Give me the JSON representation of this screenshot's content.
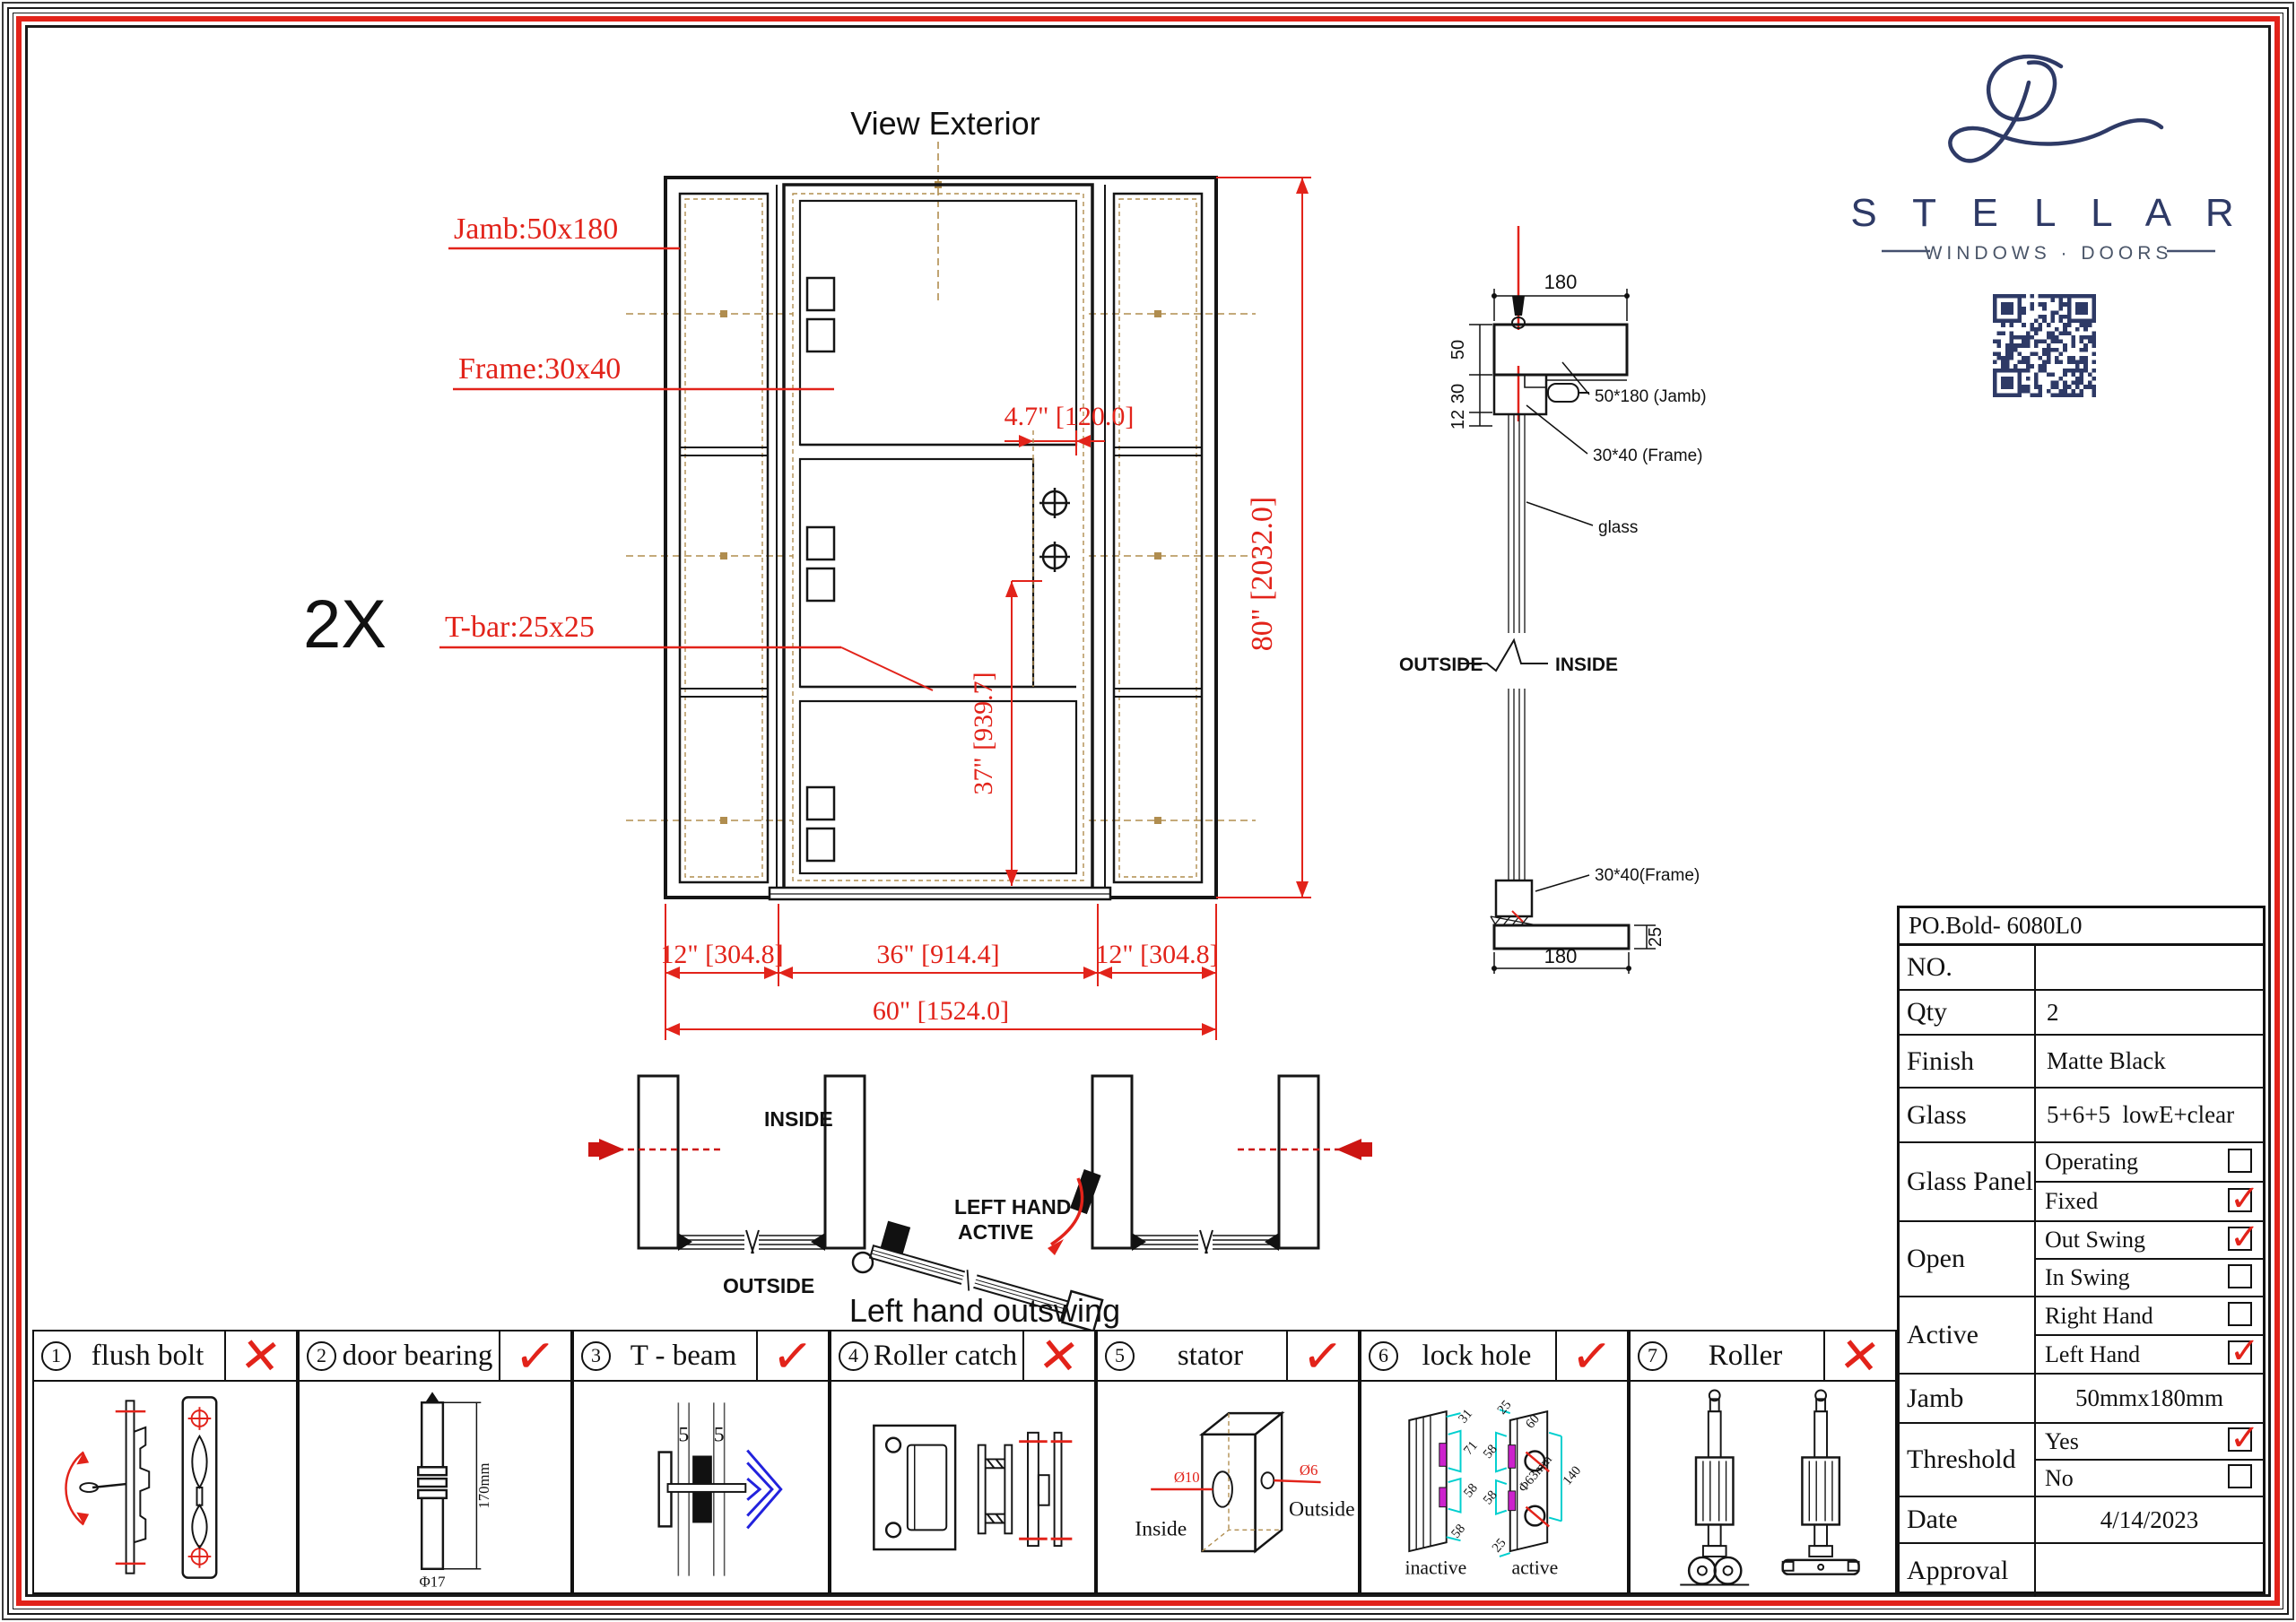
{
  "elevation": {
    "title": "View Exterior",
    "qty_note": "2X",
    "labels": {
      "jamb": "Jamb:50x180",
      "frame": "Frame:30x40",
      "tbar": "T-bar:25x25"
    },
    "dims": {
      "lock": "4.7\" [120.0]",
      "height": "80\" [2032.0]",
      "handle": "37\" [939.7]",
      "left": "12\" [304.8]",
      "center": "36\" [914.4]",
      "right": "12\" [304.8]",
      "total": "60\" [1524.0]"
    }
  },
  "section": {
    "w_top": "180",
    "h_jamb": "50",
    "h_frame": "30",
    "h_gap": "12",
    "lbl_jamb": "50*180 (Jamb)",
    "lbl_frame": "30*40  (Frame)",
    "lbl_glass": "glass",
    "outside": "OUTSIDE",
    "inside": "INSIDE",
    "lbl_frame_btm": "30*40(Frame)",
    "w_btm": "180",
    "h_threshold": "25"
  },
  "plan": {
    "inside": "INSIDE",
    "outside": "OUTSIDE",
    "hand1": "LEFT HAND",
    "hand2": "ACTIVE",
    "caption": "Left hand outswing"
  },
  "brand": {
    "name": "S T E L L A R",
    "tagline": "WINDOWS · DOORS",
    "color": "#2e3a66"
  },
  "items": [
    {
      "num": "1",
      "name": "flush bolt",
      "mark": "✕"
    },
    {
      "num": "2",
      "name": "door bearing",
      "mark": "✓",
      "len": "170mm",
      "dia": "Φ17"
    },
    {
      "num": "3",
      "name": "T - beam",
      "mark": "✓",
      "d1": "5",
      "d2": "5"
    },
    {
      "num": "4",
      "name": "Roller catch",
      "mark": "✕"
    },
    {
      "num": "5",
      "name": "stator",
      "mark": "✓",
      "hole1": "Ø10",
      "hole2": "Ø6",
      "inside": "Inside",
      "outside": "Outside"
    },
    {
      "num": "6",
      "name": "lock hole",
      "mark": "✓",
      "inactive_label": "inactive",
      "active_label": "active",
      "dims_inactive": [
        "31",
        "71",
        "58",
        "58"
      ],
      "dims_active": [
        "25",
        "60",
        "58",
        "58",
        "25",
        "140",
        "Φ63mm"
      ]
    },
    {
      "num": "7",
      "name": "Roller",
      "mark": "✕"
    }
  ],
  "table": {
    "po": "PO.Bold- 6080L0",
    "rows": [
      {
        "label": "NO.",
        "value": ""
      },
      {
        "label": "Qty",
        "value": "2"
      },
      {
        "label": "Finish",
        "value": "Matte Black"
      },
      {
        "label": "Glass",
        "value": "5+6+5  lowE+clear"
      },
      {
        "label": "Glass Panel",
        "options": [
          {
            "label": "Operating",
            "checked": false
          },
          {
            "label": "Fixed",
            "checked": true
          }
        ]
      },
      {
        "label": "Open",
        "options": [
          {
            "label": "Out Swing",
            "checked": true
          },
          {
            "label": "In Swing",
            "checked": false
          }
        ]
      },
      {
        "label": "Active",
        "options": [
          {
            "label": "Right Hand",
            "checked": false
          },
          {
            "label": "Left Hand",
            "checked": true
          }
        ]
      },
      {
        "label": "Jamb",
        "value": "50mmx180mm"
      },
      {
        "label": "Threshold",
        "options": [
          {
            "label": "Yes",
            "checked": true
          },
          {
            "label": "No",
            "checked": false
          }
        ]
      },
      {
        "label": "Date",
        "value": "4/14/2023"
      },
      {
        "label": "Approval",
        "value": ""
      }
    ]
  }
}
